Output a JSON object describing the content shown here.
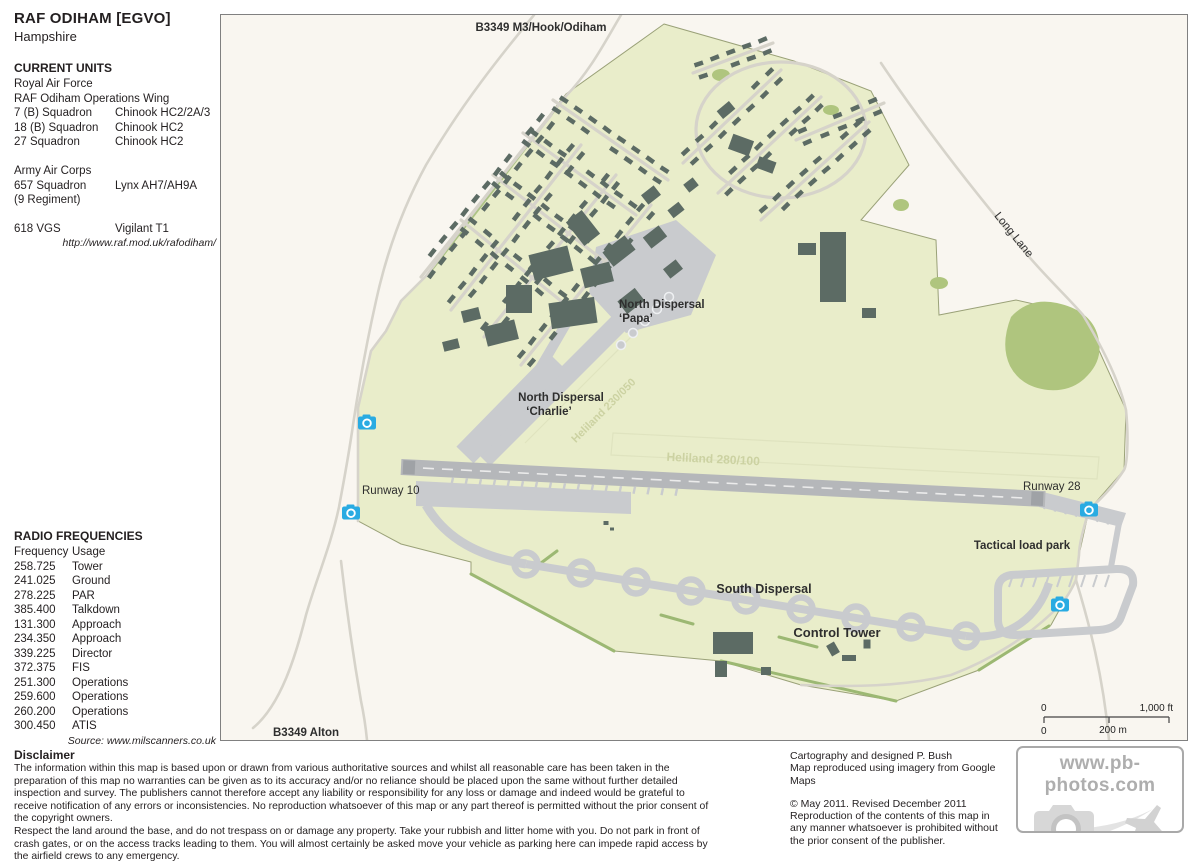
{
  "header": {
    "title": "RAF ODIHAM [EGVO]",
    "subtitle": "Hampshire"
  },
  "current_units": {
    "heading": "CURRENT UNITS",
    "rows": [
      {
        "label": "Royal Air Force",
        "value": ""
      },
      {
        "label": "RAF Odiham Operations Wing",
        "value": ""
      },
      {
        "label": "7 (B) Squadron",
        "value": "Chinook HC2/2A/3"
      },
      {
        "label": "18 (B) Squadron",
        "value": "Chinook HC2"
      },
      {
        "label": "27 Squadron",
        "value": "Chinook HC2"
      },
      {
        "label": "",
        "value": ""
      },
      {
        "label": "Army Air Corps",
        "value": ""
      },
      {
        "label": "657 Squadron",
        "value": "Lynx AH7/AH9A"
      },
      {
        "label": "(9 Regiment)",
        "value": ""
      },
      {
        "label": "",
        "value": ""
      },
      {
        "label": "618 VGS",
        "value": "Vigilant T1"
      }
    ],
    "website": "http://www.raf.mod.uk/rafodiham/"
  },
  "radio_frequencies": {
    "heading": "RADIO FREQUENCIES",
    "col_frequency": "Frequency",
    "col_usage": "Usage",
    "rows": [
      {
        "frequency": "258.725",
        "usage": "Tower"
      },
      {
        "frequency": "241.025",
        "usage": "Ground"
      },
      {
        "frequency": "278.225",
        "usage": "PAR"
      },
      {
        "frequency": "385.400",
        "usage": "Talkdown"
      },
      {
        "frequency": "131.300",
        "usage": "Approach"
      },
      {
        "frequency": "234.350",
        "usage": "Approach"
      },
      {
        "frequency": "339.225",
        "usage": "Director"
      },
      {
        "frequency": "372.375",
        "usage": "FIS"
      },
      {
        "frequency": "251.300",
        "usage": "Operations"
      },
      {
        "frequency": "259.600",
        "usage": "Operations"
      },
      {
        "frequency": "260.200",
        "usage": "Operations"
      },
      {
        "frequency": "300.450",
        "usage": "ATIS"
      }
    ],
    "source": "Source: www.milscanners.co.uk"
  },
  "map": {
    "labels": {
      "road_top": "B3349 M3/Hook/Odiham",
      "road_bottom": "B3349 Alton",
      "long_lane": "Long Lane",
      "papa_line1": "North Dispersal",
      "papa_line2": "‘Papa’",
      "charlie_line1": "North Dispersal",
      "charlie_line2": "‘Charlie’",
      "runway_10": "Runway 10",
      "runway_28": "Runway 28",
      "tactical_load_park": "Tactical load park",
      "south_dispersal": "South Dispersal",
      "control_tower": "Control Tower",
      "heliland_main": "Heliland 280/100",
      "heliland_cross": "Heliland 230/050"
    },
    "scale_bar": {
      "ft_zero": "0",
      "ft_label": "1,000 ft",
      "m_zero": "0",
      "m_label": "200 m"
    }
  },
  "disclaimer": {
    "heading": "Disclaimer",
    "p1": "The information within this map is based upon or drawn from various authoritative sources and whilst all reasonable care has been taken in the preparation of this map no warranties can be given as to its accuracy and/or no reliance should be placed upon the same without further detailed inspection and survey. The publishers cannot therefore accept any liability or responsibility for any loss or damage and indeed would be grateful to receive notification of any errors or inconsistencies. No reproduction whatsoever of this map or any part thereof is permitted without the prior consent of the copyright owners.",
    "p2": "Respect the land around the base, and do not trespass on or damage any property. Take your rubbish and litter home with you. Do not park in front of crash gates, or on the access tracks leading to them. You will almost certainly be asked move your vehicle as parking here can impede rapid access by the airfield crews to any emergency."
  },
  "credits": {
    "line1": "Cartography and designed P. Bush",
    "line2": "Map reproduced using imagery from Google Maps",
    "line3": "© May 2011. Revised December 2011",
    "line4": "Reproduction of the contents of this map in any manner whatsoever is prohibited without the prior consent of the publisher."
  },
  "watermark": {
    "text": "www.pb-photos.com"
  },
  "colors": {
    "camera": "#29abe2",
    "green": "#e9edca",
    "woods": "#afc57e",
    "runway": "#b5b7ba",
    "road": "#d6d3ca",
    "apron": "#c9cbce",
    "building": "#5c6b64",
    "mapbg": "#f9f6f0"
  }
}
